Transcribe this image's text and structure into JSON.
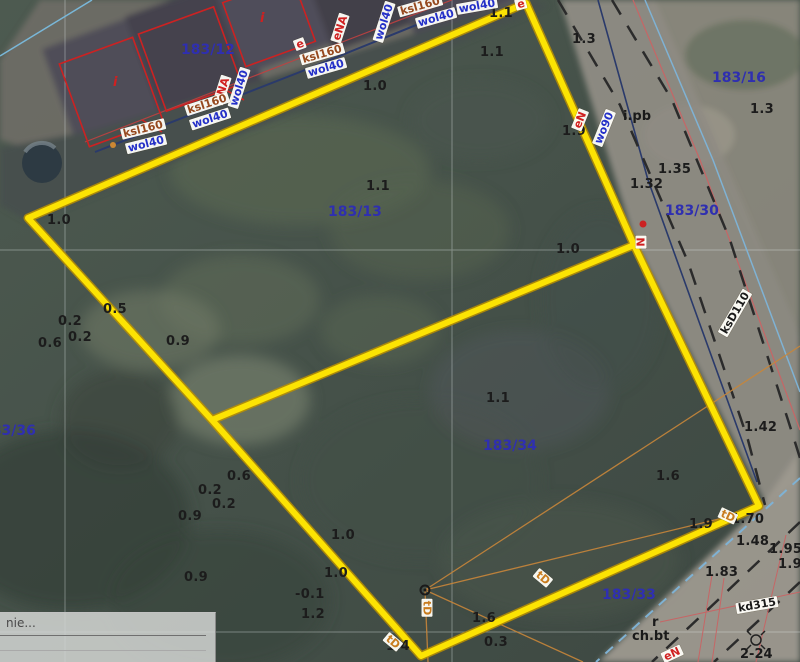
{
  "colors": {
    "boundary-yellow": "#fce303",
    "boundary-yellow-edge": "#bb9000",
    "parcel": "#2f2fb0",
    "elev": "#1c1c1c",
    "label-blue": "#2430c8",
    "label-red": "#d02020",
    "label-brown": "#96491f",
    "label-black": "#1a1a1a",
    "label-orange": "#c87c1e"
  },
  "panel": {
    "text": "nie..."
  },
  "parcel_labels": [
    {
      "t": "183/12",
      "x": 181,
      "y": 43
    },
    {
      "t": "183/13",
      "x": 328,
      "y": 205
    },
    {
      "t": "183/16",
      "x": 712,
      "y": 71
    },
    {
      "t": "183/30",
      "x": 665,
      "y": 204
    },
    {
      "t": "183/34",
      "x": 483,
      "y": 439
    },
    {
      "t": "183/33",
      "x": 602,
      "y": 588
    },
    {
      "t": "183/36",
      "x": -18,
      "y": 424
    }
  ],
  "spot_elevations": [
    {
      "t": "1.0",
      "x": 363,
      "y": 80
    },
    {
      "t": "1.1",
      "x": 480,
      "y": 46
    },
    {
      "t": "1.1",
      "x": 489,
      "y": 7
    },
    {
      "t": "1.0",
      "x": 47,
      "y": 214
    },
    {
      "t": "1.3",
      "x": 572,
      "y": 33
    },
    {
      "t": "1.9",
      "x": 562,
      "y": 125
    },
    {
      "t": "1.35",
      "x": 658,
      "y": 163
    },
    {
      "t": "1.32",
      "x": 630,
      "y": 178
    },
    {
      "t": "1.3",
      "x": 750,
      "y": 103
    },
    {
      "t": "1.1",
      "x": 366,
      "y": 180
    },
    {
      "t": "1.0",
      "x": 556,
      "y": 243
    },
    {
      "t": "0.5",
      "x": 103,
      "y": 303
    },
    {
      "t": "0.2",
      "x": 58,
      "y": 315
    },
    {
      "t": "0.2",
      "x": 68,
      "y": 331
    },
    {
      "t": "0.6",
      "x": 38,
      "y": 337
    },
    {
      "t": "0.9",
      "x": 166,
      "y": 335
    },
    {
      "t": "1.1",
      "x": 486,
      "y": 392
    },
    {
      "t": "1.6",
      "x": 656,
      "y": 470
    },
    {
      "t": "0.6",
      "x": 227,
      "y": 470
    },
    {
      "t": "0.2",
      "x": 198,
      "y": 484
    },
    {
      "t": "0.2",
      "x": 212,
      "y": 498
    },
    {
      "t": "0.9",
      "x": 178,
      "y": 510
    },
    {
      "t": "1.0",
      "x": 331,
      "y": 529
    },
    {
      "t": "1.0",
      "x": 324,
      "y": 567
    },
    {
      "t": "-0.1",
      "x": 295,
      "y": 588
    },
    {
      "t": "1.2",
      "x": 301,
      "y": 608
    },
    {
      "t": "0.9",
      "x": 184,
      "y": 571
    },
    {
      "t": "1.6",
      "x": 472,
      "y": 612
    },
    {
      "t": "0.3",
      "x": 484,
      "y": 636
    },
    {
      "t": "1.4",
      "x": 386,
      "y": 640
    },
    {
      "t": "1.42",
      "x": 744,
      "y": 421
    },
    {
      "t": "1.70",
      "x": 731,
      "y": 513
    },
    {
      "t": "1.9",
      "x": 689,
      "y": 518
    },
    {
      "t": "1.48",
      "x": 736,
      "y": 535
    },
    {
      "t": "1.95",
      "x": 769,
      "y": 543
    },
    {
      "t": "1.9",
      "x": 778,
      "y": 558
    },
    {
      "t": "1.83",
      "x": 705,
      "y": 566
    }
  ],
  "utility_labels": [
    {
      "t": "wol40",
      "c": "blue",
      "x": 239,
      "y": 88,
      "r": -72
    },
    {
      "t": "eNA",
      "c": "red",
      "x": 222,
      "y": 90,
      "r": -72
    },
    {
      "t": "ksl160",
      "c": "brown",
      "x": 207,
      "y": 104,
      "r": -18
    },
    {
      "t": "wol40",
      "c": "blue",
      "x": 210,
      "y": 119,
      "r": -18
    },
    {
      "t": "ksl160",
      "c": "brown",
      "x": 143,
      "y": 129,
      "r": -14
    },
    {
      "t": "wol40",
      "c": "blue",
      "x": 146,
      "y": 144,
      "r": -14
    },
    {
      "t": "ksl160",
      "c": "brown",
      "x": 322,
      "y": 54,
      "r": -16
    },
    {
      "t": "wol40",
      "c": "blue",
      "x": 326,
      "y": 68,
      "r": -16
    },
    {
      "t": "eNA",
      "c": "red",
      "x": 340,
      "y": 28,
      "r": -72
    },
    {
      "t": "wol40",
      "c": "blue",
      "x": 384,
      "y": 22,
      "r": -72
    },
    {
      "t": "ksl160",
      "c": "brown",
      "x": 420,
      "y": 6,
      "r": -16
    },
    {
      "t": "wol40",
      "c": "blue",
      "x": 436,
      "y": 18,
      "r": -16
    },
    {
      "t": "wol40",
      "c": "blue",
      "x": 477,
      "y": 6,
      "r": -10
    },
    {
      "t": "e",
      "c": "red",
      "x": 521,
      "y": 4,
      "r": -15
    },
    {
      "t": "e",
      "c": "red",
      "x": 300,
      "y": 44,
      "r": -20
    },
    {
      "t": "eN",
      "c": "red",
      "x": 580,
      "y": 120,
      "r": -68
    },
    {
      "t": "wo90",
      "c": "blue",
      "x": 604,
      "y": 128,
      "r": -68
    },
    {
      "t": "N",
      "c": "red",
      "x": 641,
      "y": 242,
      "r": -90
    },
    {
      "t": "ksD110",
      "c": "black",
      "x": 735,
      "y": 313,
      "r": -60
    },
    {
      "t": "kd315",
      "c": "black",
      "x": 757,
      "y": 605,
      "r": -10
    },
    {
      "t": "eN",
      "c": "red",
      "x": 672,
      "y": 654,
      "r": -25
    },
    {
      "t": "tD",
      "c": "orange",
      "x": 543,
      "y": 578,
      "r": 40
    },
    {
      "t": "tD",
      "c": "orange",
      "x": 427,
      "y": 608,
      "r": 90
    },
    {
      "t": "tD",
      "c": "orange",
      "x": 393,
      "y": 642,
      "r": 40
    },
    {
      "t": "tD",
      "c": "orange",
      "x": 728,
      "y": 516,
      "r": 25
    }
  ],
  "other_labels": [
    {
      "t": "i.pb",
      "x": 623,
      "y": 110
    },
    {
      "t": "r",
      "x": 652,
      "y": 616
    },
    {
      "t": "ch.bt",
      "x": 632,
      "y": 630
    },
    {
      "t": "2-24",
      "x": 740,
      "y": 648
    }
  ],
  "building_labels": [
    {
      "t": "i",
      "x": 113,
      "y": 76
    },
    {
      "t": "i",
      "x": 260,
      "y": 12
    }
  ]
}
